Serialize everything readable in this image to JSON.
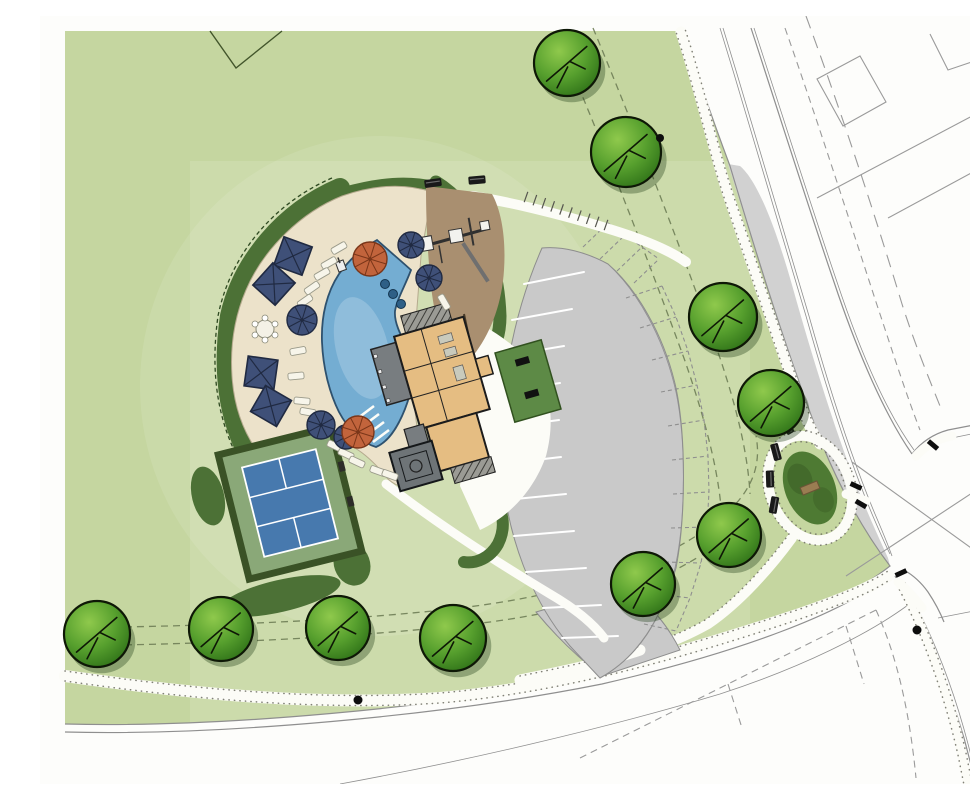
{
  "meta": {
    "title": "community-amenity-center-site-plan",
    "description": "Color rendered landscape architecture site plan: clubhouse with pool, playground, tennis court, parking, street trees and adjacent roads",
    "canvas": {
      "width": 970,
      "height": 768
    }
  },
  "palette": {
    "lawn": "#c5d6a0",
    "hedge": "#4c7136",
    "hedgeDark": "#2f4a22",
    "deck": "#ece2ca",
    "deckEdge": "#b5aa8e",
    "pool": "#74add2",
    "poolEdge": "#2e516e",
    "sand": "#a98f70",
    "bldg": "#e5bd82",
    "roof": "#787d80",
    "ink": "#1c1c1c",
    "court": "#4779ae",
    "apron": "#8aa878",
    "courtBorder": "#3a5226",
    "park": "#c9c9c9",
    "parkLine": "#8d8d8d",
    "road": "#d1d1d1",
    "curb": "#8f8f8f",
    "lot": "#9a9a9a",
    "walk": "#fcfcf7",
    "stip": "#6b6b60",
    "navy": "#3f5078",
    "navyDark": "#202a42",
    "orange": "#c2643c",
    "orangeDark": "#7a3619",
    "bench": "#191919",
    "dashGreen": "#6e7d55"
  },
  "site": {
    "counts": {
      "street_trees": 10,
      "striped_parking_stalls": 11,
      "future_dashed_stalls": 11,
      "square_cabanas": 4,
      "round_navy_umbrellas": 5,
      "orange_umbrellas": 2,
      "lounge_chairs": 15
    },
    "trees": [
      [
        527,
        47,
        33
      ],
      [
        586,
        136,
        35
      ],
      [
        683,
        301,
        34
      ],
      [
        731,
        387,
        33
      ],
      [
        689,
        519,
        32
      ],
      [
        603,
        568,
        32
      ],
      [
        57,
        618,
        33
      ],
      [
        181,
        613,
        32
      ],
      [
        298,
        612,
        32
      ],
      [
        413,
        622,
        33
      ]
    ],
    "parking_stripes": [
      [
        484,
        268,
        544,
        256
      ],
      [
        472,
        304,
        532,
        293
      ],
      [
        464,
        340,
        524,
        330
      ],
      [
        460,
        376,
        520,
        367
      ],
      [
        459,
        412,
        519,
        404
      ],
      [
        461,
        448,
        521,
        441
      ],
      [
        466,
        484,
        526,
        478
      ],
      [
        474,
        520,
        534,
        515
      ],
      [
        486,
        556,
        546,
        552
      ],
      [
        503,
        592,
        561,
        589
      ],
      [
        522,
        622,
        578,
        620
      ]
    ],
    "future_stall_ticks": [
      [
        586,
        282,
        622,
        270
      ],
      [
        600,
        312,
        636,
        301
      ],
      [
        612,
        344,
        648,
        335
      ],
      [
        621,
        376,
        657,
        369
      ],
      [
        628,
        410,
        664,
        404
      ],
      [
        632,
        444,
        668,
        440
      ],
      [
        633,
        478,
        669,
        476
      ],
      [
        631,
        512,
        667,
        511
      ],
      [
        625,
        546,
        661,
        547
      ],
      [
        616,
        578,
        650,
        582
      ],
      [
        604,
        608,
        636,
        615
      ]
    ],
    "future_stall_ticks_north": [
      [
        543,
        231,
        568,
        207
      ],
      [
        560,
        243,
        585,
        219
      ],
      [
        577,
        255,
        602,
        231
      ],
      [
        594,
        267,
        619,
        243
      ]
    ],
    "loungers": [
      [
        289,
        247,
        -30
      ],
      [
        282,
        258,
        -30
      ],
      [
        272,
        272,
        -35
      ],
      [
        265,
        285,
        -35
      ],
      [
        258,
        335,
        -10
      ],
      [
        256,
        360,
        -5
      ],
      [
        262,
        385,
        5
      ],
      [
        268,
        396,
        10
      ],
      [
        295,
        430,
        25
      ],
      [
        306,
        438,
        25
      ],
      [
        317,
        446,
        25
      ],
      [
        338,
        455,
        20
      ],
      [
        350,
        459,
        20
      ],
      [
        299,
        232,
        -30
      ],
      [
        404,
        286,
        60
      ]
    ],
    "cabana_squares": [
      [
        253,
        240,
        20
      ],
      [
        234,
        268,
        42
      ],
      [
        221,
        357,
        8
      ],
      [
        231,
        390,
        30
      ]
    ],
    "navy_umbrellas": [
      [
        262,
        304,
        15
      ],
      [
        281,
        409,
        14
      ],
      [
        306,
        421,
        12
      ],
      [
        371,
        229,
        13
      ],
      [
        389,
        262,
        13
      ]
    ],
    "orange_umbrellas": [
      [
        330,
        243,
        17
      ],
      [
        318,
        416,
        16
      ]
    ],
    "benches": [
      [
        393,
        167,
        -8
      ],
      [
        437,
        164,
        -5
      ],
      [
        747,
        410,
        60
      ],
      [
        736,
        436,
        75
      ],
      [
        730,
        463,
        88
      ],
      [
        734,
        489,
        100
      ]
    ],
    "ramp_bars": [
      [
        816,
        470,
        25
      ],
      [
        821,
        488,
        30
      ],
      [
        893,
        429,
        40
      ],
      [
        861,
        557,
        -25
      ]
    ],
    "dots": [
      [
        620,
        122,
        4
      ],
      [
        318,
        684,
        4.5
      ],
      [
        877,
        614,
        4.5
      ]
    ],
    "ladder": {
      "x1": 486,
      "y1": 181,
      "x2": 566,
      "y2": 209,
      "rungs": 10,
      "halflen": 5.5
    }
  }
}
